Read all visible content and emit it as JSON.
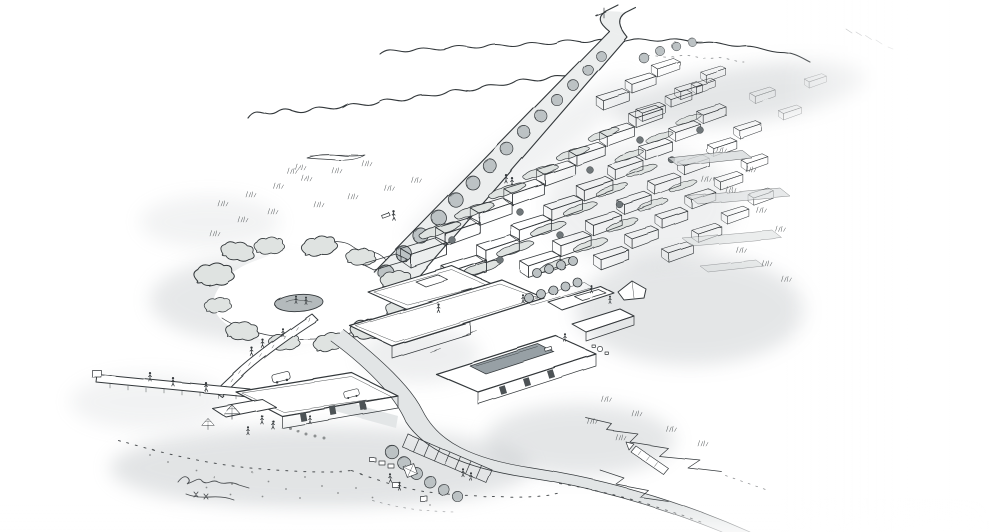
{
  "canvas": {
    "width": 990,
    "height": 532
  },
  "colors": {
    "paper": "#ffffff",
    "ink": "#33373a",
    "wash": "#a9afb3",
    "tree": "#bcc2c4",
    "tree_dark": "#70777a",
    "road": "#eceeee",
    "road_secondary": "#e2e5e6",
    "wall": "#d8dbdc",
    "green_roof": "#ccd3cc",
    "pool": "#97a0a5",
    "island": "#b4babc",
    "bush": "#dfe3e1"
  },
  "scene": {
    "style": "monochrome ink sketch, aerial perspective",
    "elements": [
      "main-street",
      "street-trees",
      "cabin-district",
      "hedgerows",
      "village-core",
      "rooftop-pool",
      "orchard-trees",
      "roundabout-green",
      "footbridge",
      "boardwalk",
      "beach-pavilion",
      "parasol",
      "access-road",
      "pedestrian-crossing",
      "parking-grove",
      "shoreline-dashes",
      "beach-dots",
      "coastal-rocks",
      "meadow-strips",
      "artist-signature"
    ]
  }
}
